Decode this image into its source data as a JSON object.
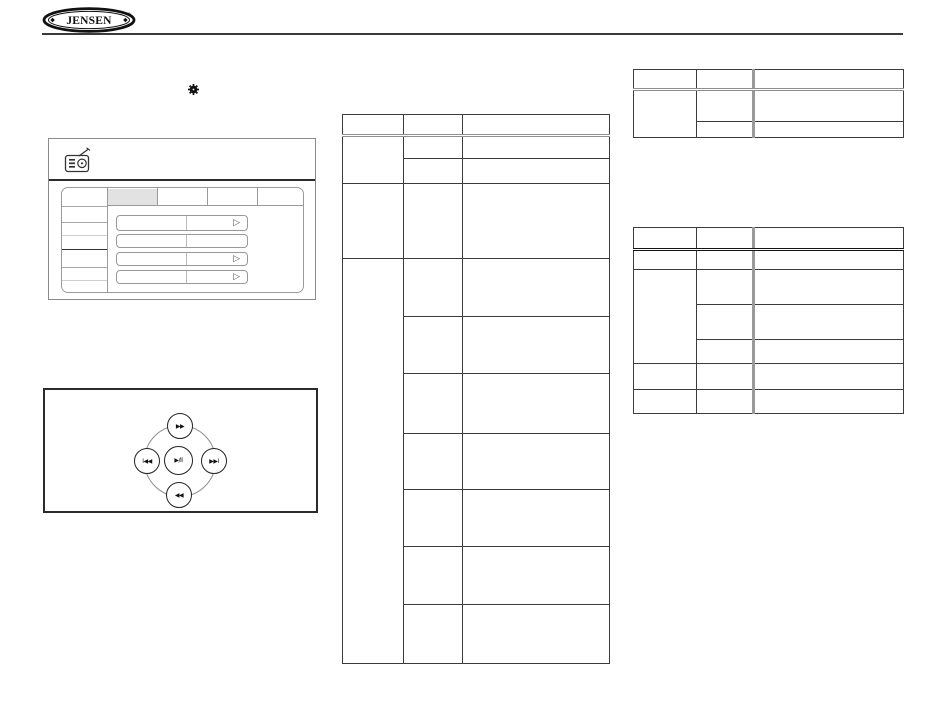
{
  "page": {
    "background": "#ffffff",
    "ink": "#1a1a1a",
    "light_line": "#999999"
  },
  "header": {
    "logo_text": "JENSEN",
    "logo_reg_mark": "®"
  },
  "settings_figure": {
    "radio_icon": "radio-icon",
    "gear_icon": "gear-icon",
    "row_arrow": "▷"
  },
  "playback_controls": {
    "top_button": "▶▶",
    "left_button": "I◀◀",
    "center_button": "▶/II",
    "right_button": "▶▶I",
    "bottom_button": "◀◀"
  }
}
